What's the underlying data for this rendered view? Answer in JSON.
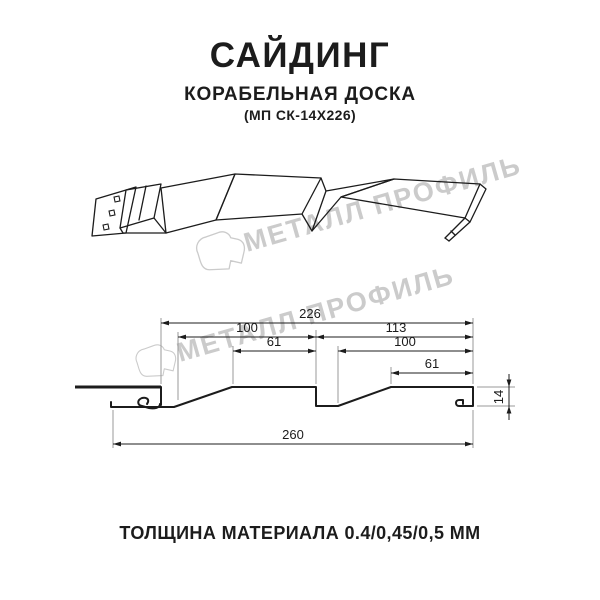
{
  "header": {
    "title": "САЙДИНГ",
    "subtitle": "КОРАБЕЛЬНАЯ ДОСКА",
    "model_code": "(МП СК-14Х226)"
  },
  "watermark": {
    "brand_text": "МЕТАЛЛ ПРОФИЛЬ",
    "color": "#cbcbcb"
  },
  "diagram": {
    "dim_overall_top": "226",
    "dim_left_board": "100",
    "dim_right_board": "113",
    "dim_left_flat": "61",
    "dim_right_upper": "100",
    "dim_right_flat": "61",
    "dim_height": "14",
    "dim_total": "260"
  },
  "footer": {
    "thickness_text": "ТОЛЩИНА МАТЕРИАЛА 0.4/0,45/0,5 ММ"
  },
  "colors": {
    "ink": "#1c1c1c",
    "extension_line": "#9a9a9a",
    "watermark": "#cbcbcb",
    "background": "#ffffff"
  }
}
